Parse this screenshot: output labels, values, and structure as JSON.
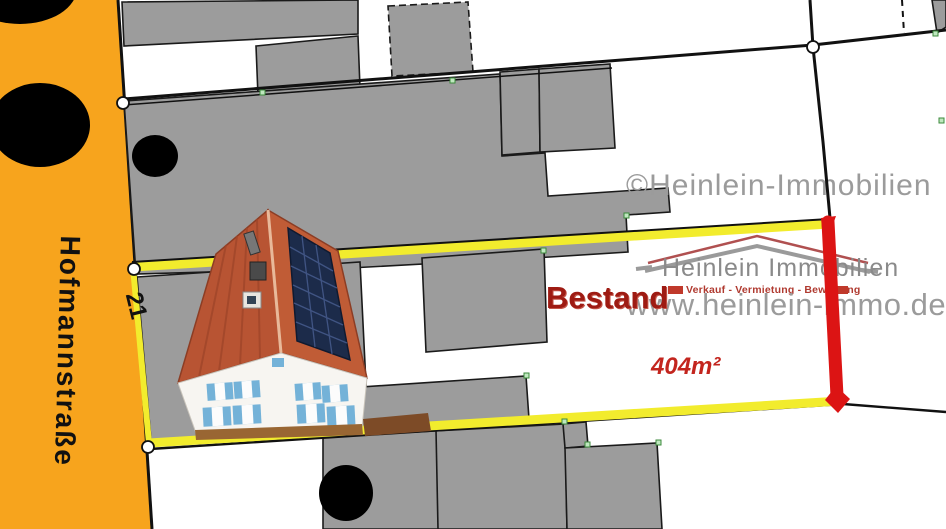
{
  "street": {
    "name": "Hofmannstraße",
    "house_number": "21"
  },
  "parcel": {
    "status_label": "Bestand",
    "area_label": "404m²"
  },
  "watermark": "©Heinlein-Immobilien",
  "branding": {
    "company": "Heinlein Immobilien",
    "tagline": "Verkauf - Vermietung - Bewertung",
    "website": "www.heinlein-immo.de"
  },
  "colors": {
    "street_orange": "#F7A41D",
    "parcel_highlight_yellow": "#F2EC2D",
    "marker_red": "#DC1414",
    "building_gray": "#9C9C9C",
    "label_red": "#9E1B13",
    "area_red": "#C3251E",
    "watermark_gray": "#9B9B9B"
  }
}
